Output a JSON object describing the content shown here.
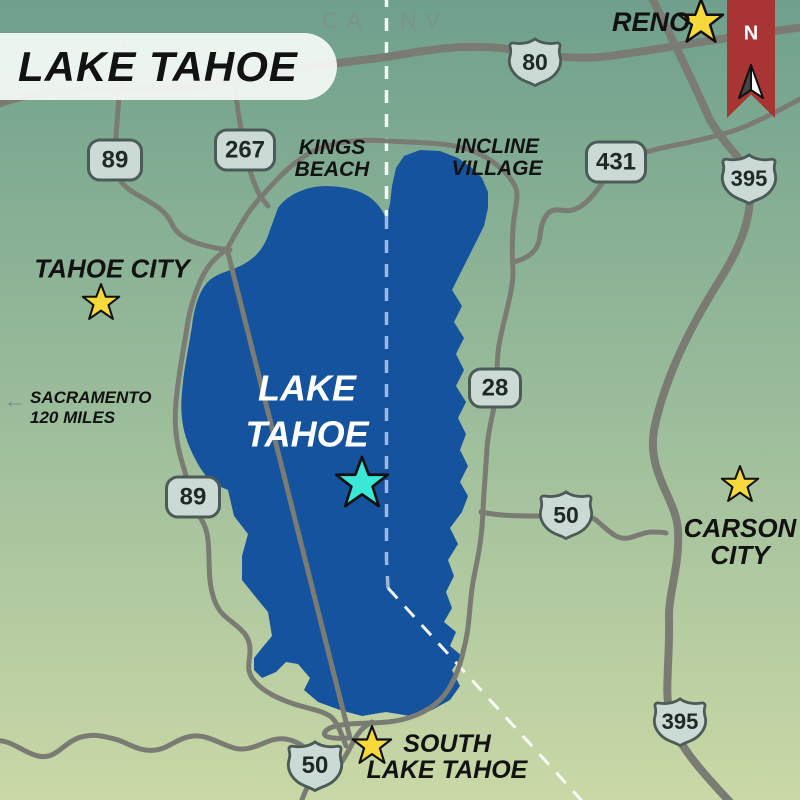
{
  "title": {
    "text": "LAKE TAHOE"
  },
  "state_line": {
    "left": "CA",
    "right": "NV"
  },
  "compass": {
    "label": "N"
  },
  "lake": {
    "label_line1": "LAKE",
    "label_line2": "TAHOE"
  },
  "cities": {
    "reno": "RENO",
    "tahoe_city": "TAHOE CITY",
    "kings_beach_l1": "KINGS",
    "kings_beach_l2": "BEACH",
    "incline_l1": "INCLINE",
    "incline_l2": "VILLAGE",
    "carson_l1": "CARSON",
    "carson_l2": "CITY",
    "south_l1": "SOUTH",
    "south_l2": "LAKE TAHOE"
  },
  "note": {
    "l1": "SACRAMENTO",
    "l2": "120 MILES",
    "arrow": "←"
  },
  "shields": {
    "i80": "80",
    "sr89_nw": "89",
    "sr267": "267",
    "sr431": "431",
    "us395_n": "395",
    "sr28": "28",
    "sr89_w": "89",
    "us50_e": "50",
    "us50_s": "50",
    "us395_s": "395"
  },
  "colors": {
    "bg_top": "#6FA08D",
    "bg_mid": "#9CBD9B",
    "bg_bottom": "#CAD8A6",
    "lake": "#15539F",
    "road": "#7A7C74",
    "shield_fill": "#CCDAD5",
    "shield_border": "#4D5B58",
    "title_text": "#121212",
    "state_label": "#7C928B",
    "ribbon_red": "#A83534",
    "star_yellow": "#F7D93B",
    "star_cyan": "#3BE8D8",
    "lake_dash": "#9DB8D8"
  }
}
